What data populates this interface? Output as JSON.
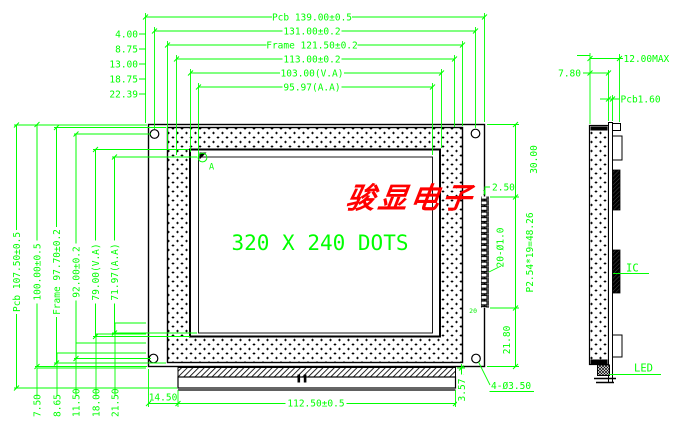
{
  "watermark_text": "骏显电子",
  "front": {
    "display_text": "320 X 240 DOTS",
    "corner_mark": "A",
    "top_dims": [
      "Pcb 139.00±0.5",
      "131.00±0.2",
      "Frame 121.50±0.2",
      "113.00±0.2",
      "103.00(V.A)",
      "95.97(A.A)"
    ],
    "top_left_dims": [
      "4.00",
      "8.75",
      "13.00",
      "18.75",
      "22.39"
    ],
    "left_dims": [
      "Pcb 107.50±0.5",
      "100.00±0.5",
      "Frame 97.70±0.2",
      "92.00±0.2",
      "79.00(V.A)",
      "71.97(A.A)"
    ],
    "bottom_left_dims": [
      "7.50",
      "8.65",
      "11.50",
      "18.00",
      "21.50"
    ],
    "bottom_dims": {
      "pcb_to_tail": "14.50",
      "tail_width": "112.50±0.5",
      "strip_height": "3.57",
      "mount_holes": "4-Ø3.50"
    },
    "right_dims": {
      "top_to_pin1": "30.00",
      "pin_edge": "2.50",
      "pin_holes": "20-Ø1.0",
      "pin_pitch": "P2.54*19=48.26",
      "pin_to_bottom": "21.80"
    },
    "pin_first": "1",
    "pin_last": "20"
  },
  "side": {
    "thickness": "7.80",
    "max_thickness": "12.00MAX",
    "pcb_thickness": "Pcb1.60",
    "ic_label": "IC",
    "led_label": "LED"
  },
  "colors": {
    "dimension_green": "#00ff00",
    "outline_black": "#000000",
    "watermark_red": "#ff0000",
    "background": "#ffffff"
  }
}
